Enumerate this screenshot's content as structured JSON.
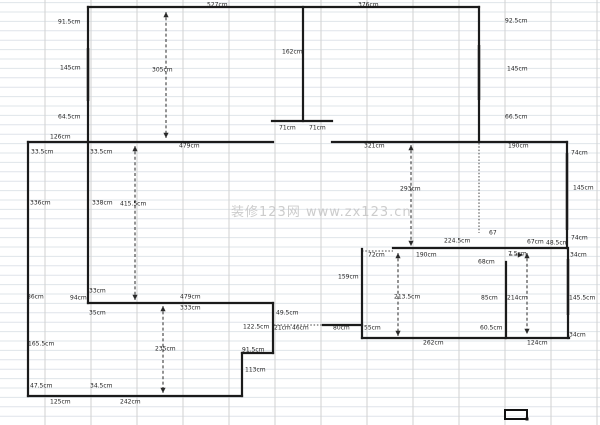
{
  "page": {
    "type": "floor-plan-drawing",
    "watermark": "装修123网 www.zx123.cn"
  },
  "diagram": {
    "canvas": {
      "width": 600,
      "height": 425,
      "background": "#ffffff"
    },
    "colors": {
      "wall": "#1b1b1b",
      "window": "#a3a3a3",
      "arrow": "#2a2a2a",
      "dotted": "#444444",
      "grid_h": "#dfe4ea",
      "grid_v": "#d2d2d2",
      "label": "#1f1f1f",
      "watermark": "#c4c4c4",
      "selection": "#111111"
    },
    "grid": {
      "h_start": 2.6,
      "h_step": 9.4,
      "v_start": 45,
      "v_step": 46
    },
    "watermark": {
      "x": 231,
      "y": 216,
      "font_size": 13
    },
    "walls": [
      {
        "x1": 88,
        "y1": 7,
        "x2": 479,
        "y2": 7
      },
      {
        "x1": 88,
        "y1": 7,
        "x2": 88,
        "y2": 142
      },
      {
        "x1": 479,
        "y1": 7,
        "x2": 479,
        "y2": 141
      },
      {
        "x1": 303,
        "y1": 7,
        "x2": 303,
        "y2": 121
      },
      {
        "x1": 272,
        "y1": 121,
        "x2": 332,
        "y2": 121
      },
      {
        "x1": 28,
        "y1": 142,
        "x2": 273,
        "y2": 142
      },
      {
        "x1": 332,
        "y1": 142,
        "x2": 567,
        "y2": 142
      },
      {
        "x1": 28,
        "y1": 142,
        "x2": 28,
        "y2": 396
      },
      {
        "x1": 88,
        "y1": 142,
        "x2": 88,
        "y2": 303
      },
      {
        "x1": 88,
        "y1": 303,
        "x2": 273,
        "y2": 303
      },
      {
        "x1": 273,
        "y1": 303,
        "x2": 273,
        "y2": 353
      },
      {
        "x1": 242,
        "y1": 353,
        "x2": 273,
        "y2": 353
      },
      {
        "x1": 242,
        "y1": 353,
        "x2": 242,
        "y2": 396
      },
      {
        "x1": 28,
        "y1": 396,
        "x2": 242,
        "y2": 396
      },
      {
        "x1": 323,
        "y1": 325,
        "x2": 362,
        "y2": 325
      },
      {
        "x1": 393,
        "y1": 248,
        "x2": 567,
        "y2": 248
      },
      {
        "x1": 362,
        "y1": 249,
        "x2": 362,
        "y2": 338
      },
      {
        "x1": 362,
        "y1": 338,
        "x2": 569,
        "y2": 338
      },
      {
        "x1": 567,
        "y1": 142,
        "x2": 567,
        "y2": 248
      },
      {
        "x1": 568,
        "y1": 248,
        "x2": 568,
        "y2": 338
      },
      {
        "x1": 506,
        "y1": 262,
        "x2": 506,
        "y2": 338
      }
    ],
    "windows": [
      {
        "x1": 88,
        "y1": 48,
        "x2": 88,
        "y2": 101
      },
      {
        "x1": 479,
        "y1": 45,
        "x2": 479,
        "y2": 100
      },
      {
        "x1": 567,
        "y1": 153,
        "x2": 567,
        "y2": 230
      },
      {
        "x1": 568,
        "y1": 259,
        "x2": 568,
        "y2": 315
      }
    ],
    "dotted_lines": [
      {
        "x1": 479,
        "y1": 143,
        "x2": 479,
        "y2": 233
      },
      {
        "x1": 274,
        "y1": 325,
        "x2": 323,
        "y2": 325
      },
      {
        "x1": 362,
        "y1": 251,
        "x2": 393,
        "y2": 251
      }
    ],
    "arrows": [
      {
        "x1": 166,
        "y1": 12,
        "x2": 166,
        "y2": 138,
        "heads": "both",
        "value": "305cm"
      },
      {
        "x1": 135,
        "y1": 146,
        "x2": 135,
        "y2": 300,
        "heads": "both",
        "value": "415.5cm"
      },
      {
        "x1": 163,
        "y1": 306,
        "x2": 163,
        "y2": 393,
        "heads": "both",
        "value": "235cm"
      },
      {
        "x1": 411,
        "y1": 145,
        "x2": 411,
        "y2": 246,
        "heads": "both",
        "value": "293cm"
      },
      {
        "x1": 398,
        "y1": 253,
        "x2": 398,
        "y2": 336,
        "heads": "both",
        "value": "213.5cm"
      },
      {
        "x1": 527,
        "y1": 253,
        "x2": 527,
        "y2": 334,
        "heads": "both",
        "value": "214cm"
      },
      {
        "x1": 509,
        "y1": 255,
        "x2": 523,
        "y2": 255,
        "heads": "end",
        "value": "7.5cm"
      }
    ],
    "labels": [
      {
        "text": "527cm",
        "x": 207,
        "y": 5
      },
      {
        "text": "376cm",
        "x": 358,
        "y": 5
      },
      {
        "text": "91.5cm",
        "x": 58,
        "y": 22
      },
      {
        "text": "145cm",
        "x": 60,
        "y": 68
      },
      {
        "text": "64.5cm",
        "x": 58,
        "y": 117
      },
      {
        "text": "162cm",
        "x": 282,
        "y": 52
      },
      {
        "text": "92.5cm",
        "x": 505,
        "y": 21
      },
      {
        "text": "145cm",
        "x": 507,
        "y": 69
      },
      {
        "text": "66.5cm",
        "x": 505,
        "y": 117
      },
      {
        "text": "71cm",
        "x": 279,
        "y": 128
      },
      {
        "text": "71cm",
        "x": 309,
        "y": 128
      },
      {
        "text": "305cm",
        "x": 152,
        "y": 70
      },
      {
        "text": "126cm",
        "x": 50,
        "y": 137
      },
      {
        "text": "479cm",
        "x": 179,
        "y": 146
      },
      {
        "text": "321cm",
        "x": 364,
        "y": 146
      },
      {
        "text": "190cm",
        "x": 508,
        "y": 146
      },
      {
        "text": "33.5cm",
        "x": 31,
        "y": 152
      },
      {
        "text": "33.5cm",
        "x": 90,
        "y": 152
      },
      {
        "text": "336cm",
        "x": 30,
        "y": 203
      },
      {
        "text": "338cm",
        "x": 92,
        "y": 203
      },
      {
        "text": "415.5cm",
        "x": 120,
        "y": 204
      },
      {
        "text": "74cm",
        "x": 571,
        "y": 153
      },
      {
        "text": "145cm",
        "x": 573,
        "y": 188
      },
      {
        "text": "293cm",
        "x": 400,
        "y": 189
      },
      {
        "text": "74cm",
        "x": 571,
        "y": 238
      },
      {
        "text": "34cm",
        "x": 570,
        "y": 255
      },
      {
        "text": "67",
        "x": 489,
        "y": 233
      },
      {
        "text": "224.5cm",
        "x": 444,
        "y": 241
      },
      {
        "text": "67cm",
        "x": 527,
        "y": 242
      },
      {
        "text": "48.5cm",
        "x": 546,
        "y": 243
      },
      {
        "text": "72cm",
        "x": 368,
        "y": 255
      },
      {
        "text": "190cm",
        "x": 416,
        "y": 255
      },
      {
        "text": "7.5cm",
        "x": 508,
        "y": 254
      },
      {
        "text": "68cm",
        "x": 478,
        "y": 262
      },
      {
        "text": "159cm",
        "x": 338,
        "y": 277
      },
      {
        "text": "86cm",
        "x": 27,
        "y": 297
      },
      {
        "text": "94cm",
        "x": 70,
        "y": 298
      },
      {
        "text": "33cm",
        "x": 89,
        "y": 291
      },
      {
        "text": "35cm",
        "x": 89,
        "y": 313
      },
      {
        "text": "479cm",
        "x": 180,
        "y": 297
      },
      {
        "text": "333cm",
        "x": 180,
        "y": 308
      },
      {
        "text": "49.5cm",
        "x": 276,
        "y": 313
      },
      {
        "text": "122.5cm",
        "x": 243,
        "y": 327
      },
      {
        "text": "21cm",
        "x": 274,
        "y": 328
      },
      {
        "text": "46cm",
        "x": 292,
        "y": 328
      },
      {
        "text": "80cm",
        "x": 333,
        "y": 328
      },
      {
        "text": "55cm",
        "x": 364,
        "y": 328
      },
      {
        "text": "213.5cm",
        "x": 394,
        "y": 297
      },
      {
        "text": "85cm",
        "x": 481,
        "y": 298
      },
      {
        "text": "214cm",
        "x": 507,
        "y": 298
      },
      {
        "text": "145.5cm",
        "x": 569,
        "y": 298
      },
      {
        "text": "60.5cm",
        "x": 480,
        "y": 328
      },
      {
        "text": "34cm",
        "x": 569,
        "y": 335
      },
      {
        "text": "165.5cm",
        "x": 28,
        "y": 344
      },
      {
        "text": "235cm",
        "x": 155,
        "y": 349
      },
      {
        "text": "91.5cm",
        "x": 242,
        "y": 350
      },
      {
        "text": "113cm",
        "x": 245,
        "y": 370
      },
      {
        "text": "47.5cm",
        "x": 30,
        "y": 386
      },
      {
        "text": "34.5cm",
        "x": 90,
        "y": 386
      },
      {
        "text": "125cm",
        "x": 50,
        "y": 402
      },
      {
        "text": "242cm",
        "x": 120,
        "y": 402
      },
      {
        "text": "262cm",
        "x": 423,
        "y": 343
      },
      {
        "text": "124cm",
        "x": 527,
        "y": 343
      }
    ],
    "selection_cell": {
      "x": 505,
      "y": 410,
      "w": 22,
      "h": 9
    }
  }
}
